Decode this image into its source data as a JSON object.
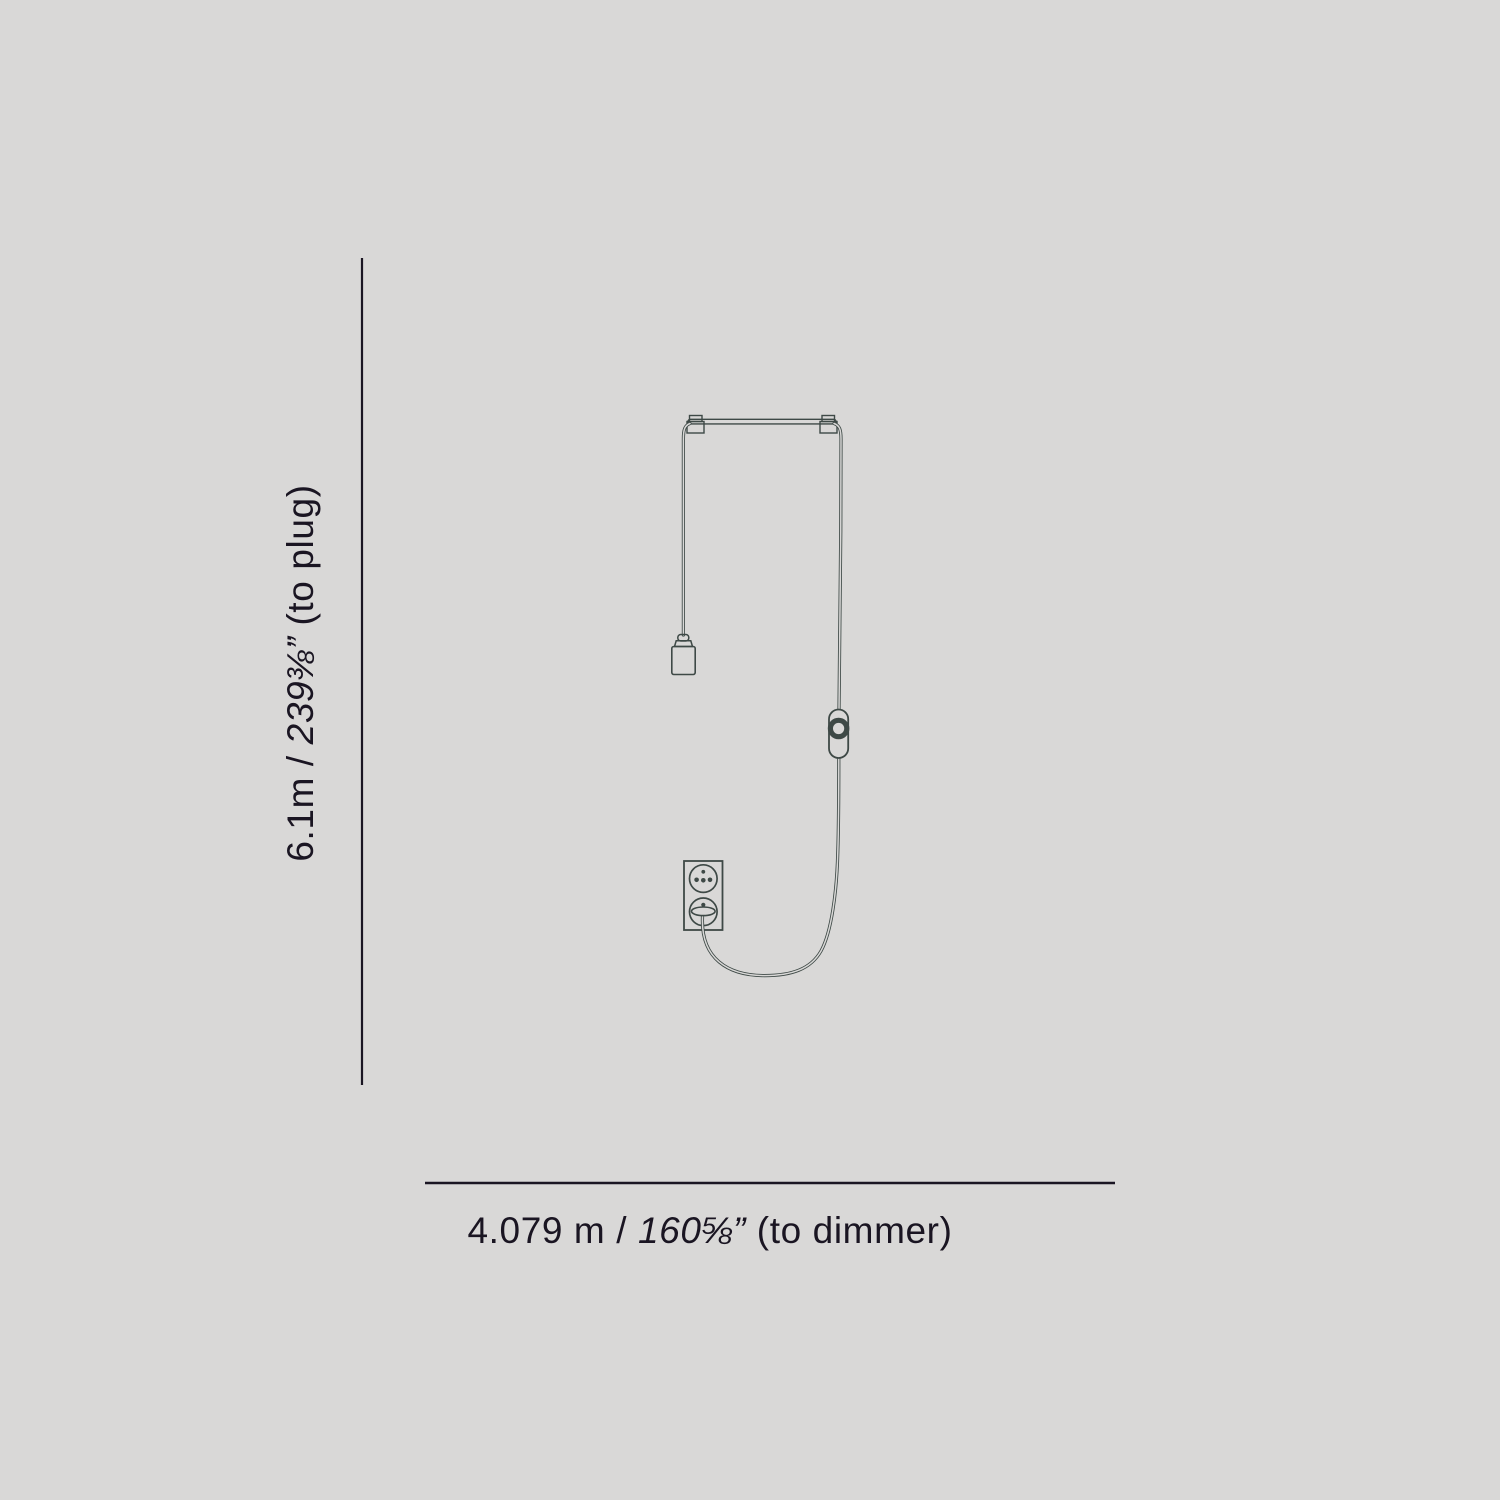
{
  "colors": {
    "background": "#d9d8d7",
    "artwork_stroke": "#3e4946",
    "dimension_ink": "#1a1522"
  },
  "dimensions": {
    "vertical": {
      "metric": "6.1m",
      "separator": " / ",
      "imperial": "239⅜”",
      "suffix": " (to plug)"
    },
    "horizontal": {
      "metric": "4.079 m",
      "separator": " /  ",
      "imperial": "160⅝”",
      "suffix": " (to dimmer)"
    }
  },
  "drawing": {
    "parts": [
      "pendant-bar",
      "power-cord",
      "lamp-socket",
      "dimmer-switch",
      "wall-outlet",
      "power-plug"
    ]
  }
}
